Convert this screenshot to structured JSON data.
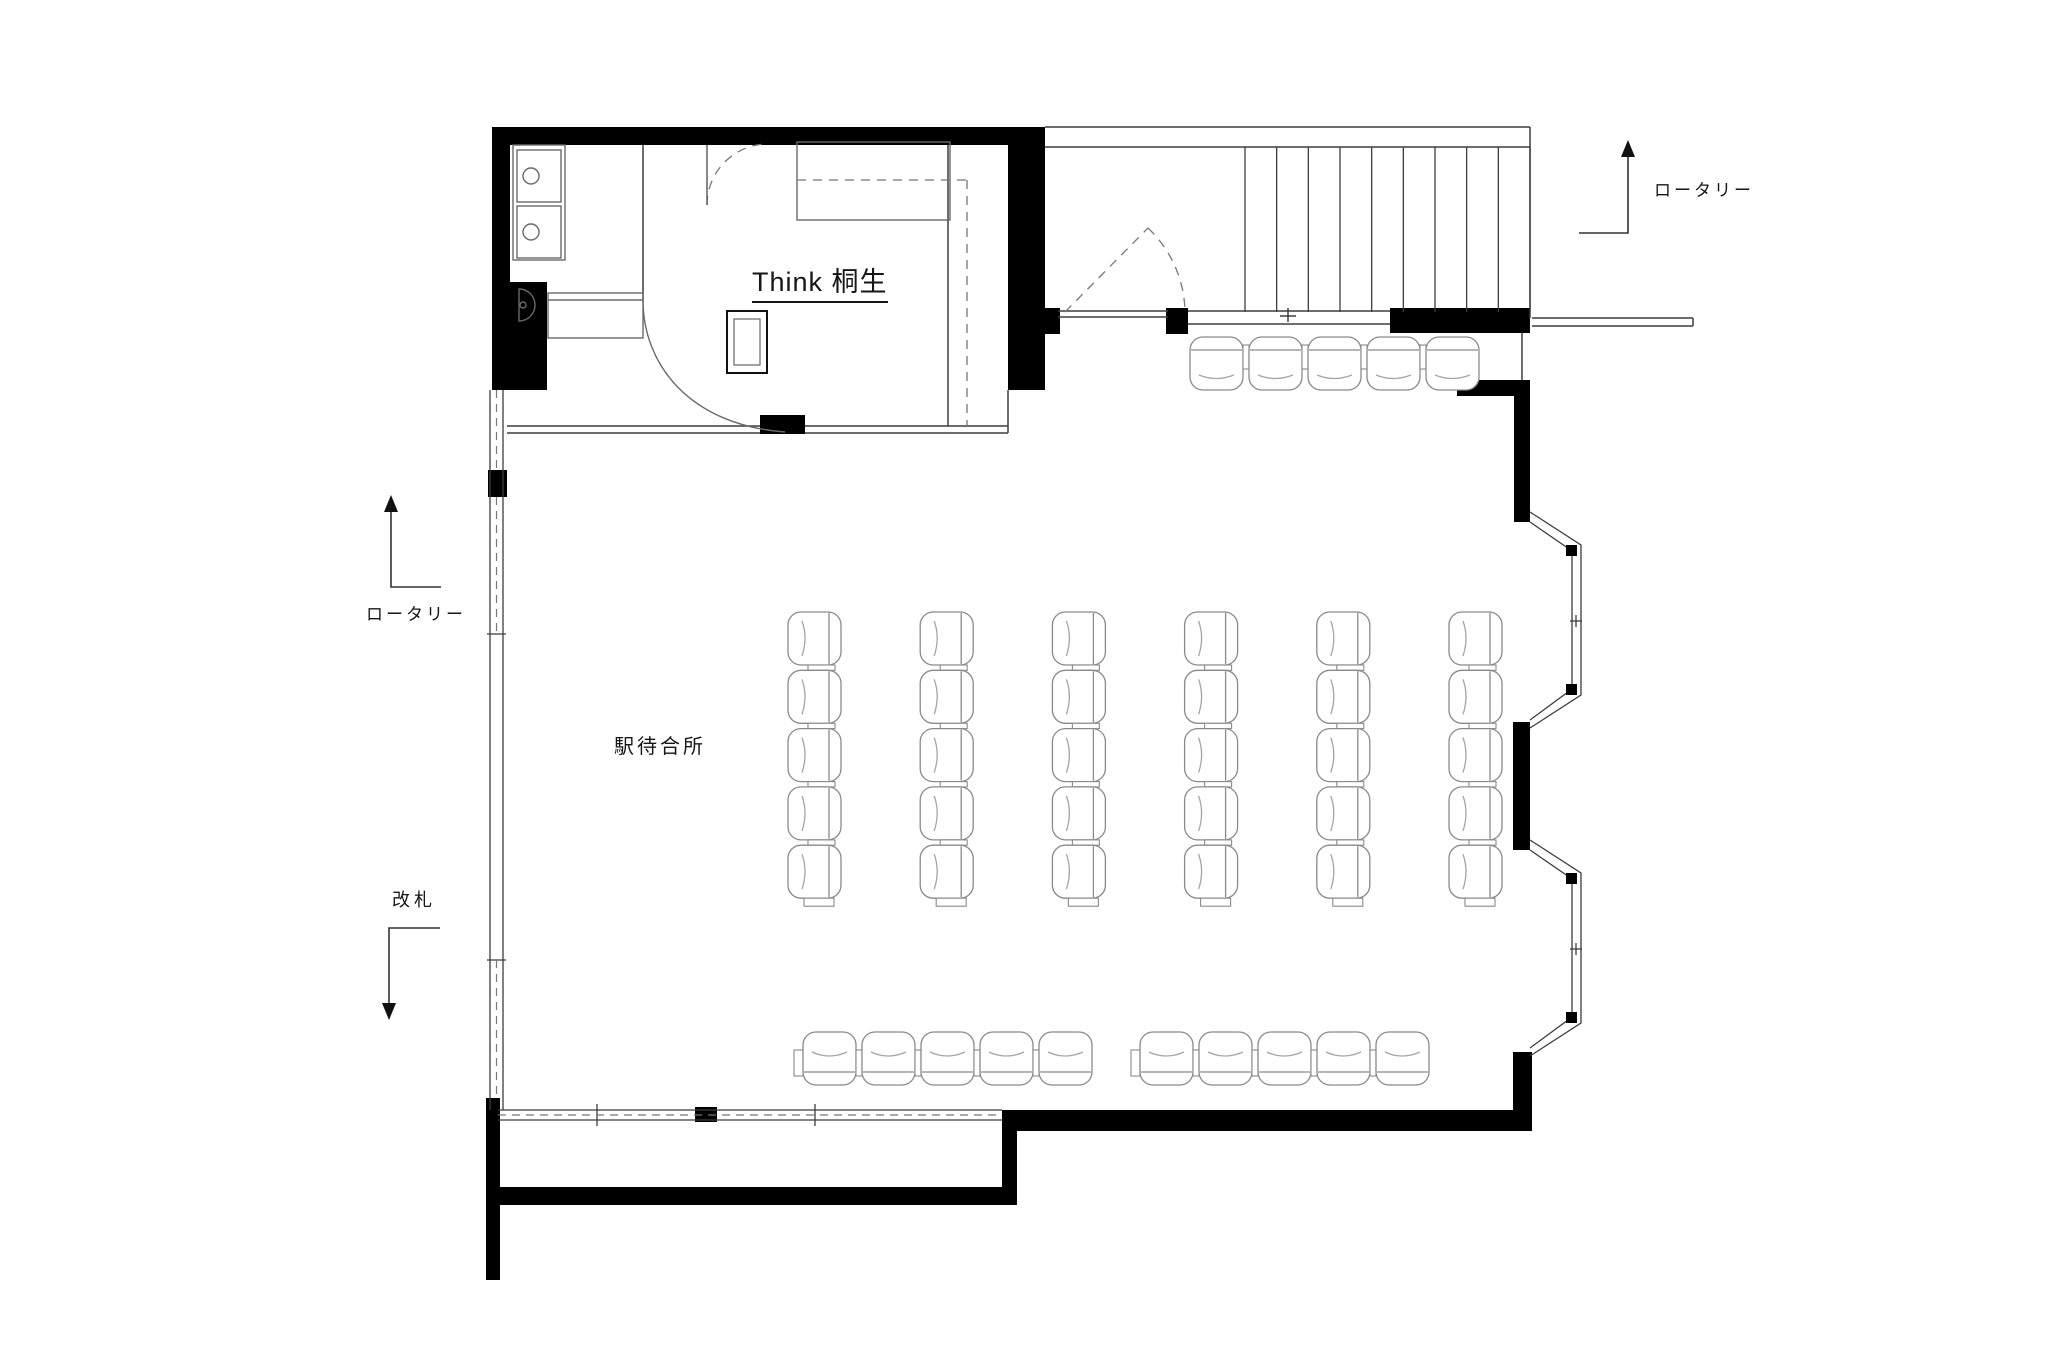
{
  "labels": {
    "shop_name": "Think 桐生",
    "waiting_room": "駅待合所",
    "rotary_top": "ロータリー",
    "rotary_left": "ロータリー",
    "ticket_gate": "改札"
  },
  "colors": {
    "wall": "#000000",
    "structure_line": "#3d3d3d",
    "furniture_line": "#8a8a8a",
    "dashed_line": "#777777",
    "text": "#161616",
    "background": "#ffffff"
  },
  "plan": {
    "stairs": {
      "x0": 1245,
      "x1": 1530,
      "y0": 147,
      "y1": 312,
      "treads": 9
    },
    "bays": [
      {
        "cy": 621
      },
      {
        "cy": 949
      }
    ],
    "seating": {
      "chair_size": 53,
      "center_columns": {
        "x0": 788,
        "y0": 612,
        "cols": 6,
        "rows": 5,
        "col_pitch": 132.2,
        "row_pitch": 58.3
      },
      "top_row": {
        "x0": 1190,
        "y": 337,
        "count": 5,
        "pitch": 59
      },
      "bottom_rows": [
        {
          "x0": 803,
          "y": 1032,
          "count": 5,
          "pitch": 59
        },
        {
          "x0": 1140,
          "y": 1032,
          "count": 5,
          "pitch": 59
        }
      ]
    }
  }
}
